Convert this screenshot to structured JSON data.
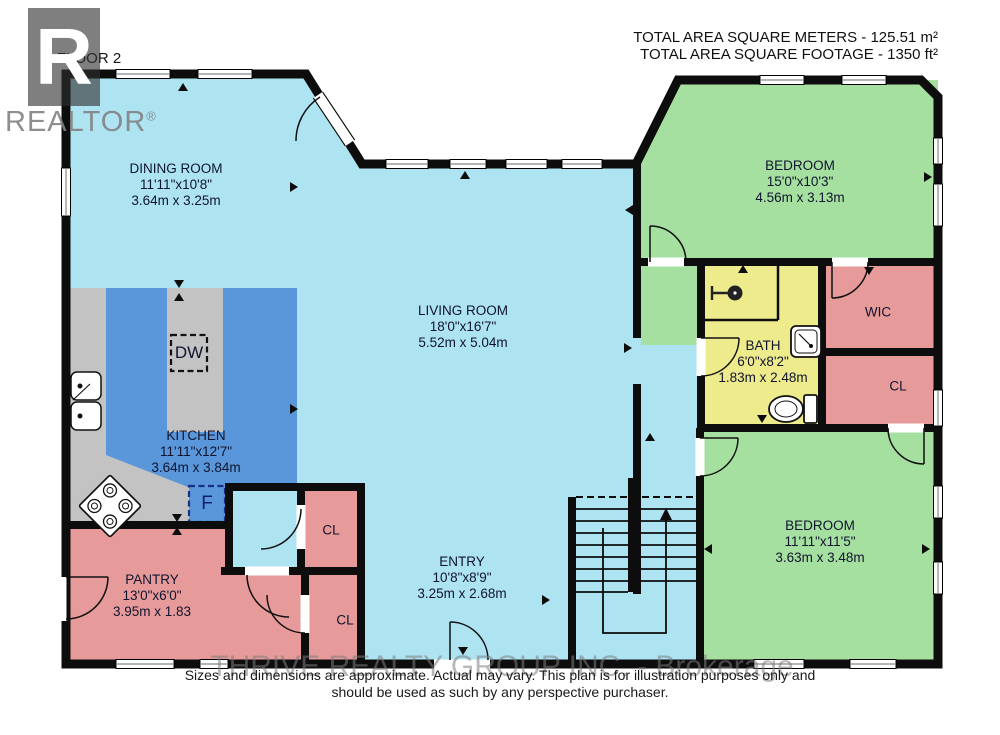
{
  "branding": {
    "logo_letter": "R",
    "wordmark": "REALTOR",
    "registered_mark": "®"
  },
  "header": {
    "floor_label": "FLOOR 2",
    "total_area_metric": "TOTAL AREA SQUARE METERS - 125.51 m²",
    "total_area_imperial": "TOTAL AREA SQUARE FOOTAGE - 1350 ft²"
  },
  "rooms": [
    {
      "id": "dining-room",
      "name": "DINING ROOM",
      "dim_ft": "11'11\"x10'8\"",
      "dim_m": "3.64m x 3.25m"
    },
    {
      "id": "living-room",
      "name": "LIVING ROOM",
      "dim_ft": "18'0\"x16'7\"",
      "dim_m": "5.52m x 5.04m"
    },
    {
      "id": "kitchen",
      "name": "KITCHEN",
      "dim_ft": "11'11\"x12'7\"",
      "dim_m": "3.64m x 3.84m"
    },
    {
      "id": "bedroom-upper",
      "name": "BEDROOM",
      "dim_ft": "15'0\"x10'3\"",
      "dim_m": "4.56m x 3.13m"
    },
    {
      "id": "bath",
      "name": "BATH",
      "dim_ft": "6'0\"x8'2\"",
      "dim_m": "1.83m x 2.48m"
    },
    {
      "id": "bedroom-lower",
      "name": "BEDROOM",
      "dim_ft": "11'11\"x11'5\"",
      "dim_m": "3.63m x 3.48m"
    },
    {
      "id": "pantry",
      "name": "PANTRY",
      "dim_ft": "13'0\"x6'0\"",
      "dim_m": "3.95m x 1.83"
    },
    {
      "id": "entry",
      "name": "ENTRY",
      "dim_ft": "10'8\"x8'9\"",
      "dim_m": "3.25m x 2.68m"
    }
  ],
  "closets": {
    "wic": "WIC",
    "cl": "CL"
  },
  "appliances": {
    "dishwasher": "DW",
    "fridge": "F"
  },
  "footer": {
    "watermark": "THRIVE REALTY GROUP INC. - Brokerage",
    "disclaimer_line1": "Sizes and dimensions are approximate. Actual may vary. This plan is for illustration purposes only and",
    "disclaimer_line2": "should be used as such by any perspective purchaser."
  },
  "colors": {
    "floor_main": "#aee3f2",
    "floor_kitchen": "#5997da",
    "floor_bedroom": "#a6e0a0",
    "floor_bath": "#eeeb8c",
    "floor_closet": "#e79a9a",
    "counter": "#c3c3c3",
    "wall": "#0d0d0d"
  }
}
